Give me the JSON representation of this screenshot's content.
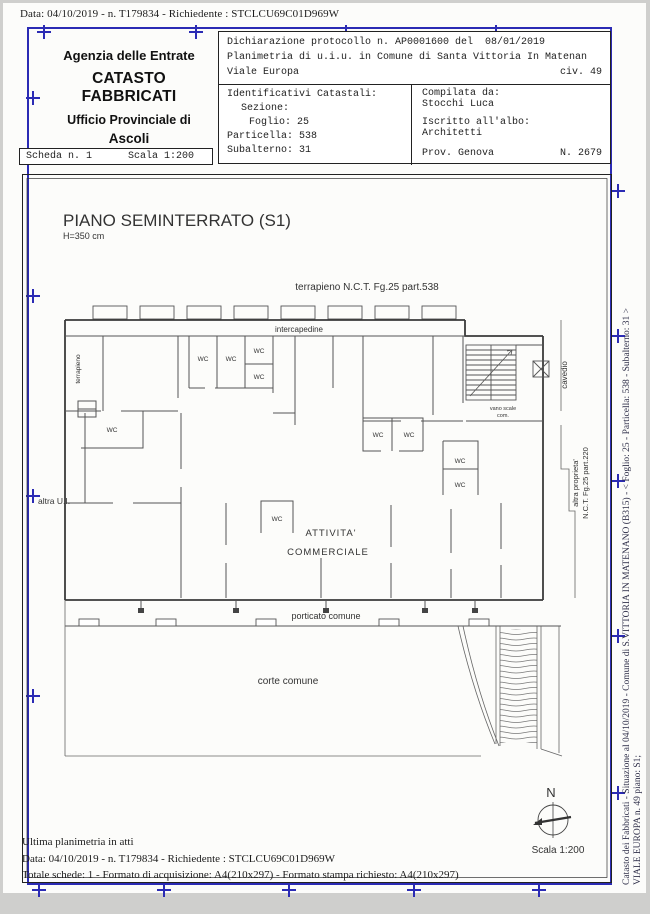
{
  "page": {
    "top_line": "Data: 04/10/2019 - n. T179834 - Richiedente : STCLCU69C01D969W"
  },
  "header": {
    "agency": {
      "line1": "Agenzia delle Entrate",
      "line2": "CATASTO FABBRICATI",
      "line3": "Ufficio Provinciale di",
      "line4": "Ascoli"
    },
    "scheda": {
      "label": "Scheda n. 1",
      "scale": "Scala 1:200"
    },
    "declaration": {
      "protocol": "Dichiarazione protocollo n. AP0001600 del  08/01/2019",
      "planimetria": "Planimetria di u.i.u. in Comune di Santa Vittoria In Matenan",
      "street": "Viale Europa",
      "civic": "civ. 49"
    },
    "identifiers": {
      "title": "Identificativi Catastali:",
      "sezione": "Sezione:",
      "foglio": "Foglio: 25",
      "particella": "Particella: 538",
      "subalterno": "Subalterno: 31"
    },
    "compiler": {
      "label": "Compilata da:",
      "name": "Stocchi Luca",
      "albo_label": "Iscritto all'albo:",
      "albo": "Architetti",
      "prov": "Prov. Genova",
      "num": "N. 2679"
    }
  },
  "plan": {
    "title": "PIANO SEMINTERRATO (S1)",
    "height_note": "H=350 cm",
    "labels": {
      "terrapieno_top": "terrapieno N.C.T. Fg.25 part.538",
      "intercapedine": "intercapedine",
      "terrapieno_left": "terrapieno",
      "wc": "WC",
      "vano_scale_1": "vano scale",
      "vano_scale_2": "com.",
      "cavedio": "cavedio",
      "altra_ui": "altra U.I.",
      "altra_prop_1": "altra proprieta'",
      "altra_prop_2": "N.C.T. Fg.25 part.220",
      "attivita_1": "ATTIVITA'",
      "attivita_2": "COMMERCIALE",
      "porticato": "porticato comune",
      "corte": "corte comune"
    },
    "compass": "N",
    "scale": "Scala 1:200"
  },
  "footer": {
    "line1": "Ultima planimetria in atti",
    "line2": "Data: 04/10/2019 - n. T179834 - Richiedente : STCLCU69C01D969W",
    "line3": "Totale schede: 1 - Formato di acquisizione: A4(210x297)  - Formato stampa richiesto: A4(210x297)"
  },
  "side_margin": {
    "line1": "Catasto dei Fabbricati - Situazione al 04/10/2019 - Comune di S.VITTORIA IN MATENANO (B315) - < Foglio: 25 - Particella: 538 - Subalterno: 31 >",
    "line2": "VIALE EUROPA n. 49 piano: S1;"
  },
  "colors": {
    "frame_blue": "#2b2bb4"
  }
}
